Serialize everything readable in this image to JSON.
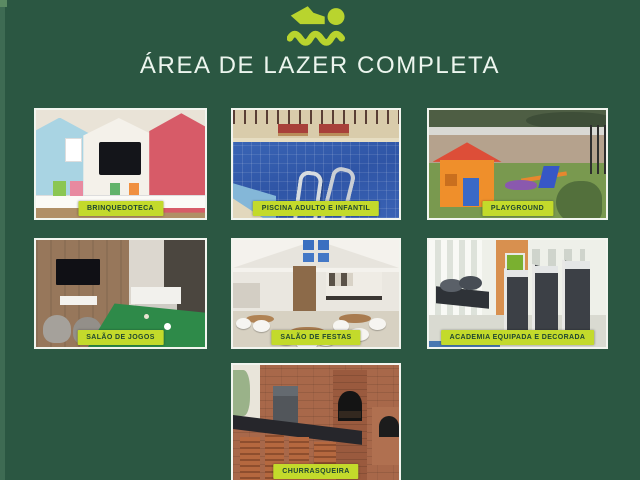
{
  "header": {
    "title": "ÁREA DE LAZER COMPLETA",
    "icon": "swimmer-icon"
  },
  "photos": [
    {
      "id": "brinquedoteca",
      "label": "BRINQUEDOTECA"
    },
    {
      "id": "piscina",
      "label": "PISCINA ADULTO E INFANTIL"
    },
    {
      "id": "playground",
      "label": "PLAYGROUND"
    },
    {
      "id": "salao-de-jogos",
      "label": "SALÃO DE JOGOS"
    },
    {
      "id": "salao-de-festas",
      "label": "SALÃO DE FESTAS"
    },
    {
      "id": "academia",
      "label": "ACADEMIA EQUIPADA E DECORADA"
    },
    {
      "id": "churrasqueira",
      "label": "CHURRASQUEIRA"
    }
  ],
  "colors": {
    "background": "#2b5742",
    "accent": "#c3da2b",
    "title_text": "#ecf5ee",
    "badge_text": "#1f4631",
    "photo_border": "#f2f5ef"
  }
}
